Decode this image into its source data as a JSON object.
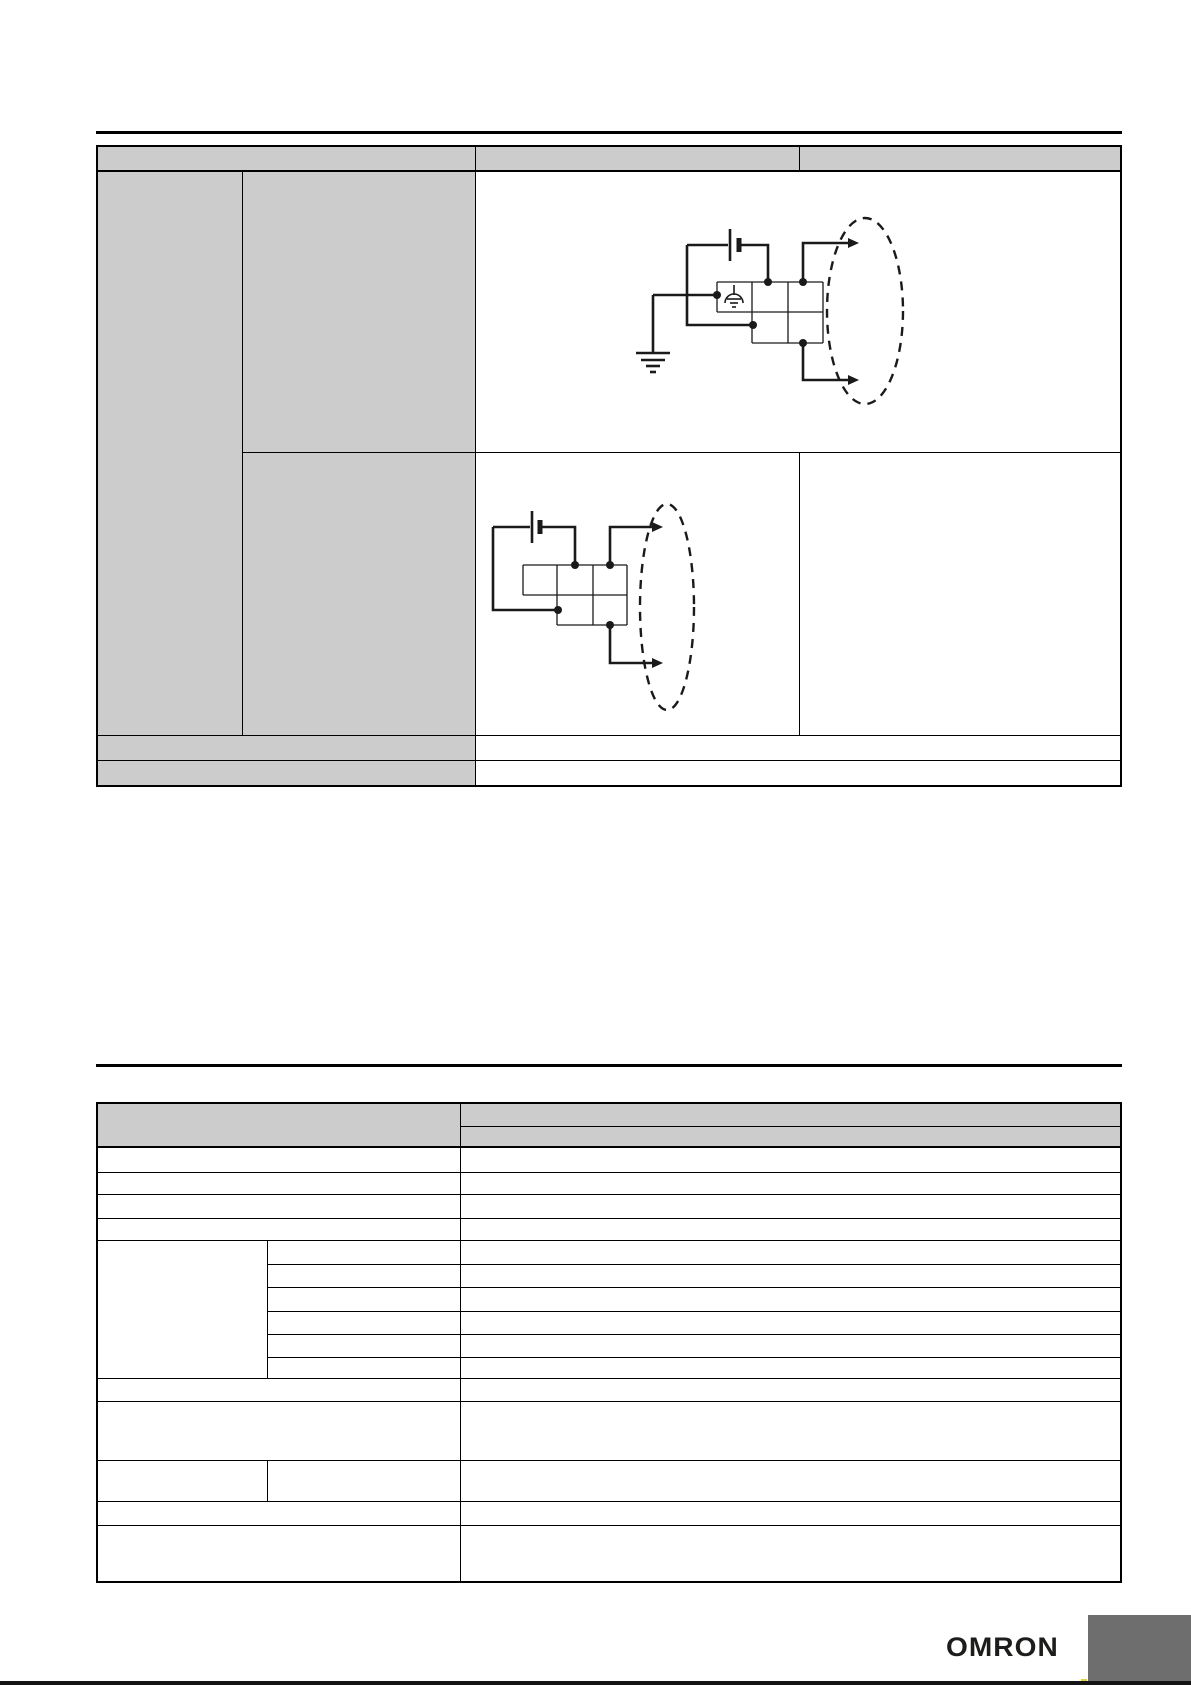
{
  "page": {
    "brand_label": "OMRON"
  },
  "colors": {
    "cell_gray": "#cccccc",
    "line_black": "#000000",
    "footer_box_gray": "#6e6e6e",
    "bottom_edge_black": "#141414",
    "accent_mark_yellow": "#e5d23b",
    "brand_ink": "#1d1d1b"
  },
  "icons": {
    "battery": "battery-icon",
    "ground": "earth-ground-icon",
    "functional_earth": "functional-earth-icon",
    "output_arrow": "arrow-right-icon",
    "highlight": "dashed-ellipse-highlight",
    "terminal_block": "terminal-block-grid"
  },
  "table1": {
    "header": [
      "",
      "",
      ""
    ],
    "cells": [
      "",
      "",
      "",
      "",
      "",
      "",
      "",
      "",
      ""
    ]
  },
  "table2": {
    "header": [
      "",
      "",
      ""
    ],
    "cells": [
      "",
      "",
      "",
      "",
      "",
      "",
      "",
      "",
      "",
      "",
      "",
      "",
      "",
      "",
      "",
      "",
      "",
      "",
      "",
      "",
      "",
      "",
      "",
      "",
      "",
      "",
      "",
      "",
      ""
    ]
  }
}
